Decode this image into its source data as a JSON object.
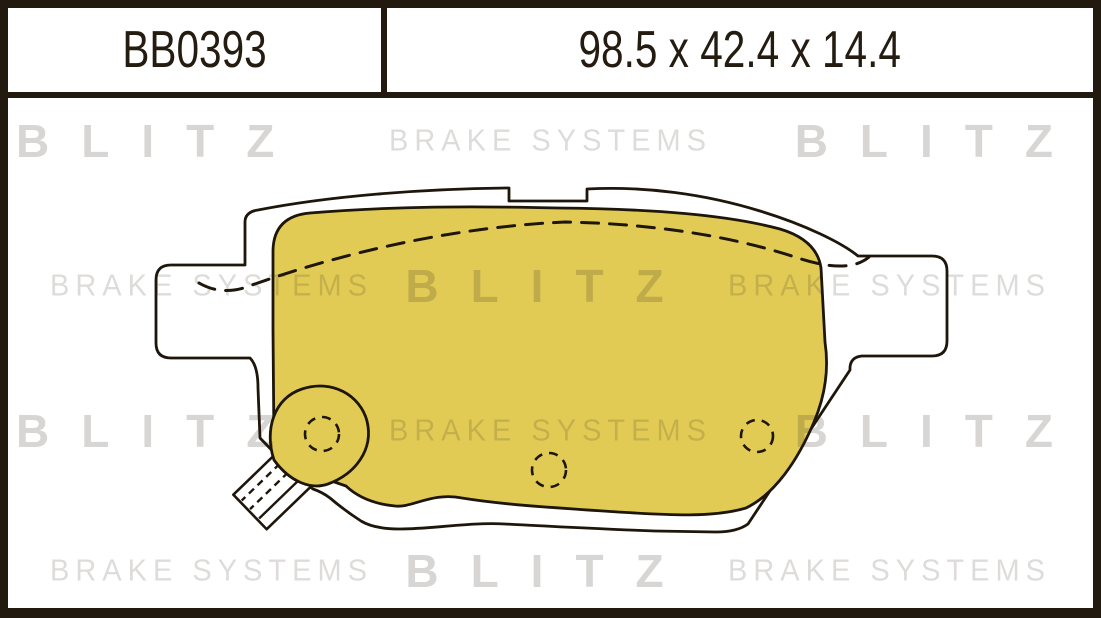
{
  "header": {
    "part_number": "BB0393",
    "dimensions": "98.5 x 42.4 x 14.4"
  },
  "watermark": {
    "rows": [
      [
        "BLITZ",
        "BRAKE SYSTEMS",
        "BLITZ"
      ],
      [
        "BRAKE SYSTEMS",
        "BLITZ",
        "BRAKE SYSTEMS"
      ],
      [
        "BLITZ",
        "BRAKE SYSTEMS",
        "BLITZ"
      ],
      [
        "BRAKE SYSTEMS",
        "BLITZ",
        "BRAKE SYSTEMS"
      ]
    ]
  },
  "colors": {
    "frame_dark": "#221a0e",
    "pad_yellow": "#e2cb55",
    "line_dark": "#1e160a",
    "watermark_gray": "#d9d7d4"
  }
}
